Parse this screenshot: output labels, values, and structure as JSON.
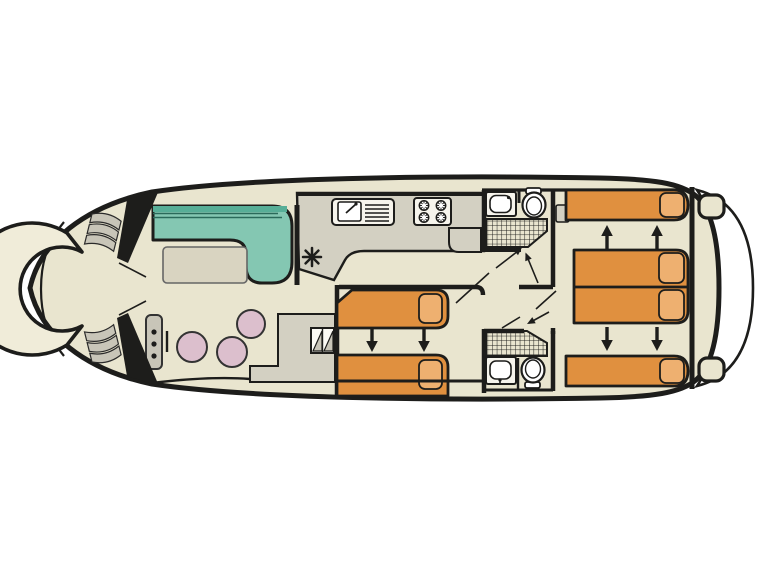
{
  "diagram": {
    "type": "boat-deck-plan",
    "colors": {
      "paper": "#ffffff",
      "outline": "#1d1d1b",
      "deck": "#e9e5cf",
      "floor_gray": "#d3d0c2",
      "sofa": "#84c7b2",
      "sofa_dark": "#57ae97",
      "table": "#d9d4c1",
      "bed": "#e0903f",
      "pillow": "#eeb070",
      "stool": "#dcbfcd",
      "steps": "#c8c5b8",
      "fixture": "#f6f4ec"
    },
    "features": {
      "bow_cockpit": [
        "curved-bench",
        "steps-port",
        "steps-starboard",
        "bulkhead-doors"
      ],
      "salon": [
        "l-shaped-sofa",
        "table",
        "heater-asterisk-symbol",
        "helm-console",
        "stool",
        "stool",
        "stool",
        "side-deck-steps"
      ],
      "galley": [
        "sink-with-drainboard",
        "stove-4-burner",
        "wardrobe-cabinet"
      ],
      "bathroom_fore": [
        "washbasin",
        "toilet",
        "shower",
        "access-arrows"
      ],
      "cabin_mid": [
        "single-bed",
        "single-bed",
        "bed-slide-arrows"
      ],
      "bathroom_aft": [
        "washbasin",
        "toilet",
        "shower",
        "access-arrow"
      ],
      "cabin_aft": [
        "single-bed-top",
        "convertible-double-bed",
        "single-bed-bottom",
        "bed-slide-arrows"
      ],
      "stern": [
        "stern-deck",
        "swim-platform",
        "boarding-steps",
        "boarding-steps"
      ]
    }
  }
}
